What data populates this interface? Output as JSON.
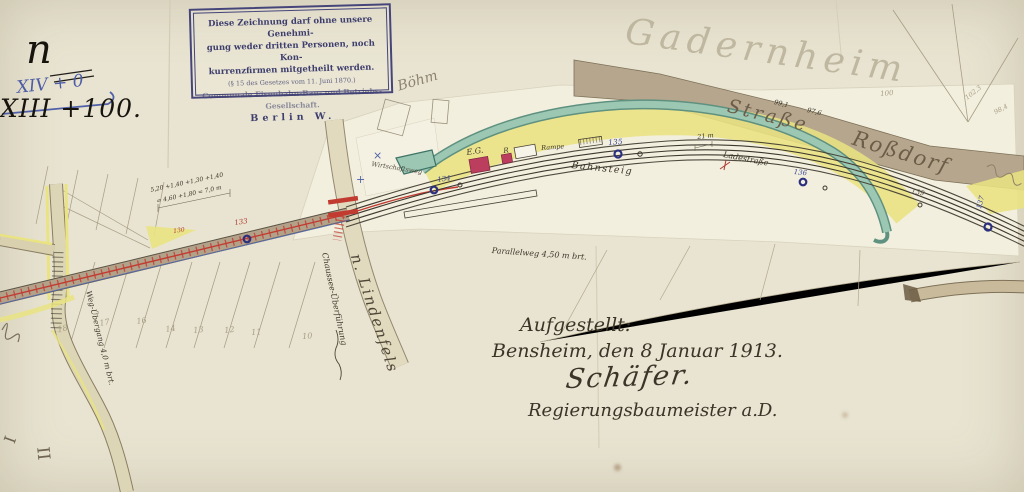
{
  "corner_notes": {
    "letter": "n",
    "revision_new": "XIV + 0",
    "revision_old": "XIII +100."
  },
  "stamp": {
    "line1": "Diese Zeichnung darf ohne unsere Genehmi-",
    "line2": "gung weder dritten Personen, noch Kon-",
    "line3": "kurrenzfirmen mitgetheilt werden.",
    "line4": "(§ 15 des Gesetzes vom 11. Juni 1870.)",
    "line5": "Communale Eisenbahn-Bau- und Betriebs-Gesellschaft.",
    "line6": "Berlin W."
  },
  "pencil_notes": {
    "place": "Gadernheim",
    "name": "Böhm"
  },
  "map": {
    "labels": {
      "strasse": "Straße",
      "rossdorf": "Roßdorf",
      "ladestrasse": "Ladestraße",
      "bahnsteig": "Bahnsteig",
      "rampe": "Rampe",
      "station_building": "E.G.",
      "shed": "R",
      "parallelweg": "Parallelweg 4,50 m brt.",
      "wirtschaftsweg": "Wirtschaftsweg",
      "chaussee_bridge": "Chaussee-Überführung",
      "road_destination": "n. Lindenfels",
      "weg_uebergang": "Weg-Übergang 4,0 m brt."
    },
    "markers": [
      {
        "label": "130"
      },
      {
        "label": "133"
      },
      {
        "label": "134"
      },
      {
        "label": "135"
      },
      {
        "label": "136"
      },
      {
        "label": "137"
      },
      {
        "label": "139"
      }
    ],
    "parcels": [
      "18",
      "17",
      "16",
      "14",
      "13",
      "12",
      "11",
      "10"
    ],
    "elevations": [
      "99,1",
      "97,6",
      "100",
      "102,3",
      "98,4"
    ],
    "measurements": {
      "line1": "5,20 +1,40  +1,30 +1,40",
      "line2": "= 4,60 +1,80 = 7,0 m",
      "width": "21 m"
    },
    "sections": {
      "s1": "I",
      "s2": "II"
    }
  },
  "signature_block": {
    "line1": "Aufgestellt:",
    "line2": "Bensheim, den 8 Januar 1913.",
    "line3": "Schäfer.",
    "line4": "Regierungsbaumeister a.D."
  },
  "colors": {
    "ink": "#3b3428",
    "blue_ink": "#4d5ca6",
    "red": "#b0392e",
    "yellow": "#e9e382",
    "stream": "#9cc7b3",
    "road": "#b5a68d",
    "paper": "#e8e4d1"
  }
}
